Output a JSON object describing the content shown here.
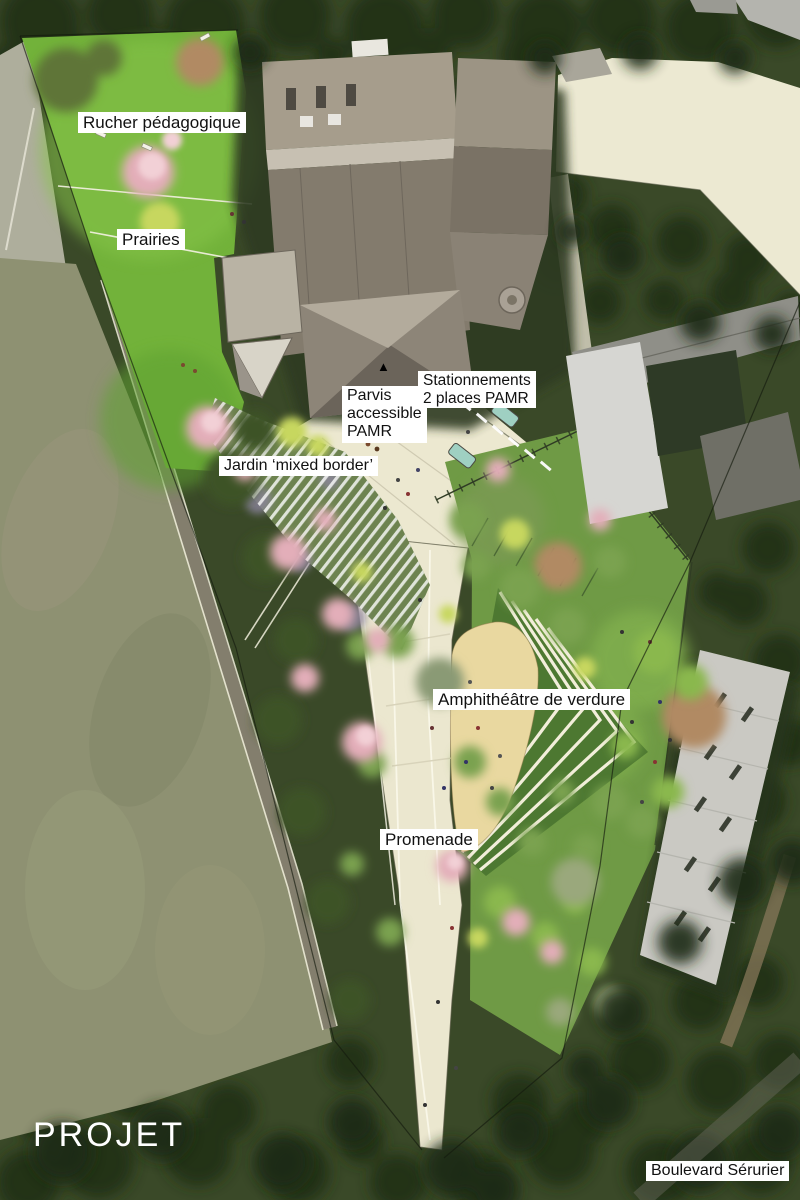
{
  "title": "PROJET",
  "labels": {
    "rucher": "Rucher pédagogique",
    "prairies": "Prairies",
    "parvis": [
      "Parvis",
      "accessible",
      "PAMR"
    ],
    "stationnements": [
      "Stationnements",
      "2 places PAMR"
    ],
    "jardin": "Jardin ‘mixed border’",
    "amphitheatre": "Amphithéâtre de verdure",
    "promenade": "Promenade",
    "boulevard": "Boulevard Sérurier"
  },
  "icons": {
    "parvis_marker": "▲"
  },
  "colors": {
    "lawn_green": "#72b23a",
    "field_olive": "#8e9172",
    "path_cream": "#ece8d0",
    "sand_beige": "#e9d8a0",
    "tier_green": "#4d7831",
    "canopy_dark": "#243119",
    "roof_gray": "#847c6e",
    "housing_white": "#cac9c3",
    "blossom_pink": "#e3aeb9",
    "foliage_yellow": "#c7d75f",
    "car_teal": "#9fd0c2",
    "label_bg": "#ffffff",
    "label_text": "#111111",
    "title_color": "#ffffff"
  }
}
